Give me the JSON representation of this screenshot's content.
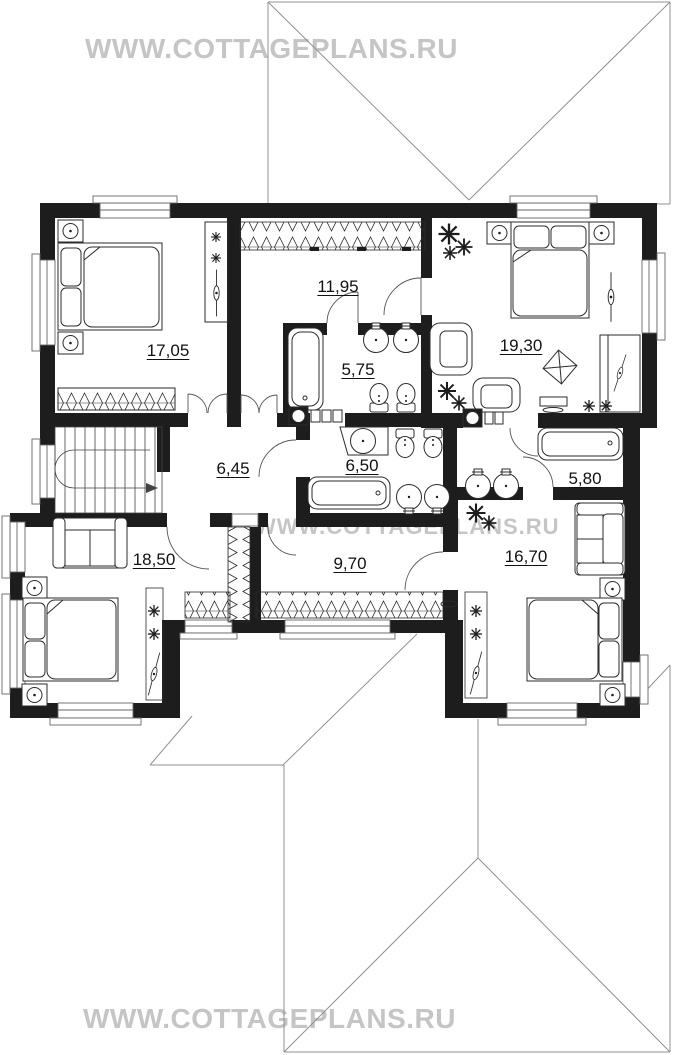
{
  "site": {
    "watermark_top": "WWW.COTTAGEPLANS.RU",
    "watermark_middle": "WWW.COTTAGEPLANS.RU",
    "watermark_bottom": "WWW.COTTAGEPLANS.RU"
  },
  "floor_plan": {
    "type": "second-floor cottage plan, top view",
    "rooms": {
      "bedroom_top_left": {
        "area": "17,05"
      },
      "dressing_room_middle": {
        "area": "11,95"
      },
      "bedroom_top_right": {
        "area": "19,30"
      },
      "bathroom_top": {
        "area": "5,75"
      },
      "hall_stairs": {
        "area": "6,45"
      },
      "bathroom_middle": {
        "area": "6,50"
      },
      "bathroom_right": {
        "area": "5,80"
      },
      "bedroom_bottom_left": {
        "area": "18,50"
      },
      "corridor": {
        "area": "9,70"
      },
      "bedroom_bottom_right": {
        "area": "16,70"
      }
    },
    "colors": {
      "wall": "#1d1d1d",
      "furniture_line": "#2b2b2b",
      "roof_line": "#909090",
      "watermark": "#c5c5c5"
    }
  }
}
